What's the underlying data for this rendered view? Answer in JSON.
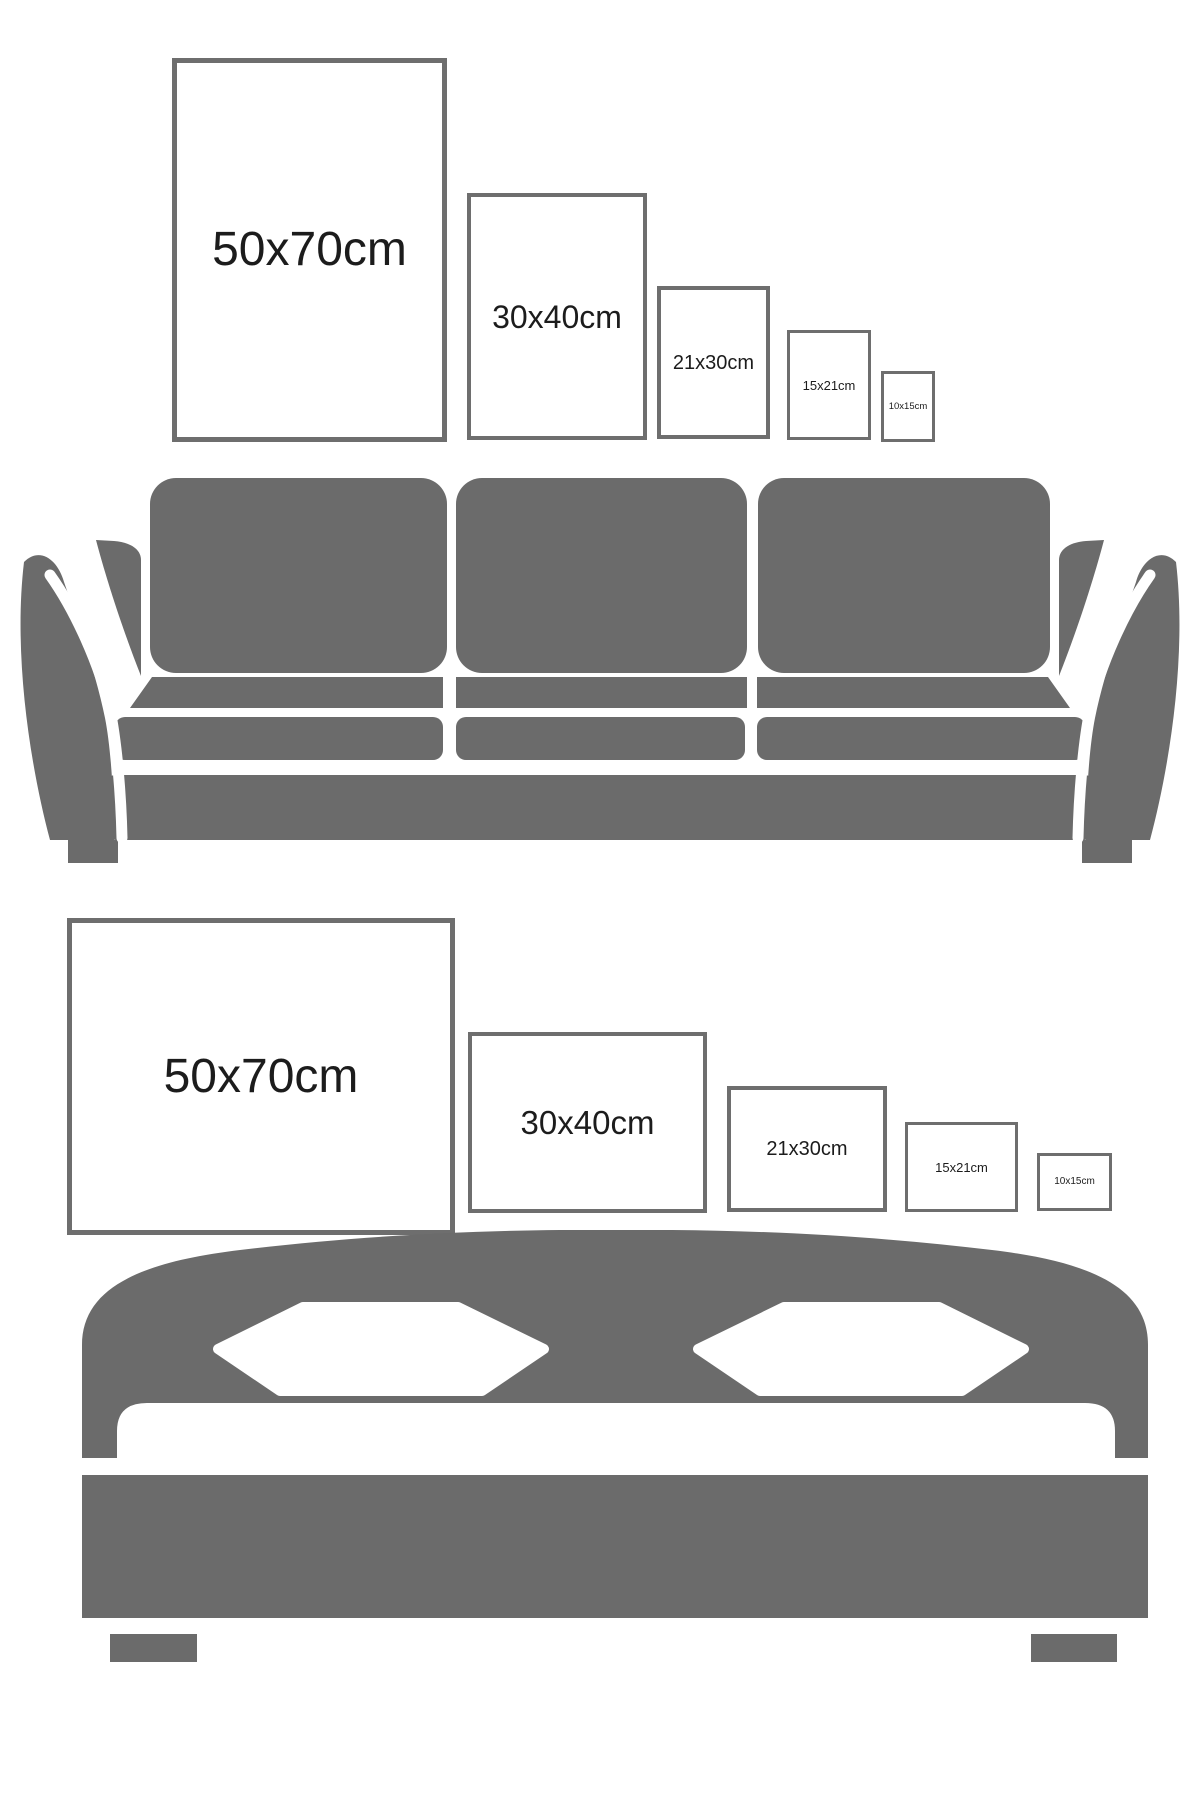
{
  "colors": {
    "background": "#ffffff",
    "furniture-gray": "#6b6b6b",
    "frame-border": "#6e6e6e",
    "label-color": "#1c1c1c"
  },
  "top_row": {
    "frames": [
      {
        "label": "50x70cm"
      },
      {
        "label": "30x40cm"
      },
      {
        "label": "21x30cm"
      },
      {
        "label": "15x21cm"
      },
      {
        "label": "10x15cm"
      }
    ]
  },
  "bottom_row": {
    "frames": [
      {
        "label": "50x70cm"
      },
      {
        "label": "30x40cm"
      },
      {
        "label": "21x30cm"
      },
      {
        "label": "15x21cm"
      },
      {
        "label": "10x15cm"
      }
    ]
  }
}
